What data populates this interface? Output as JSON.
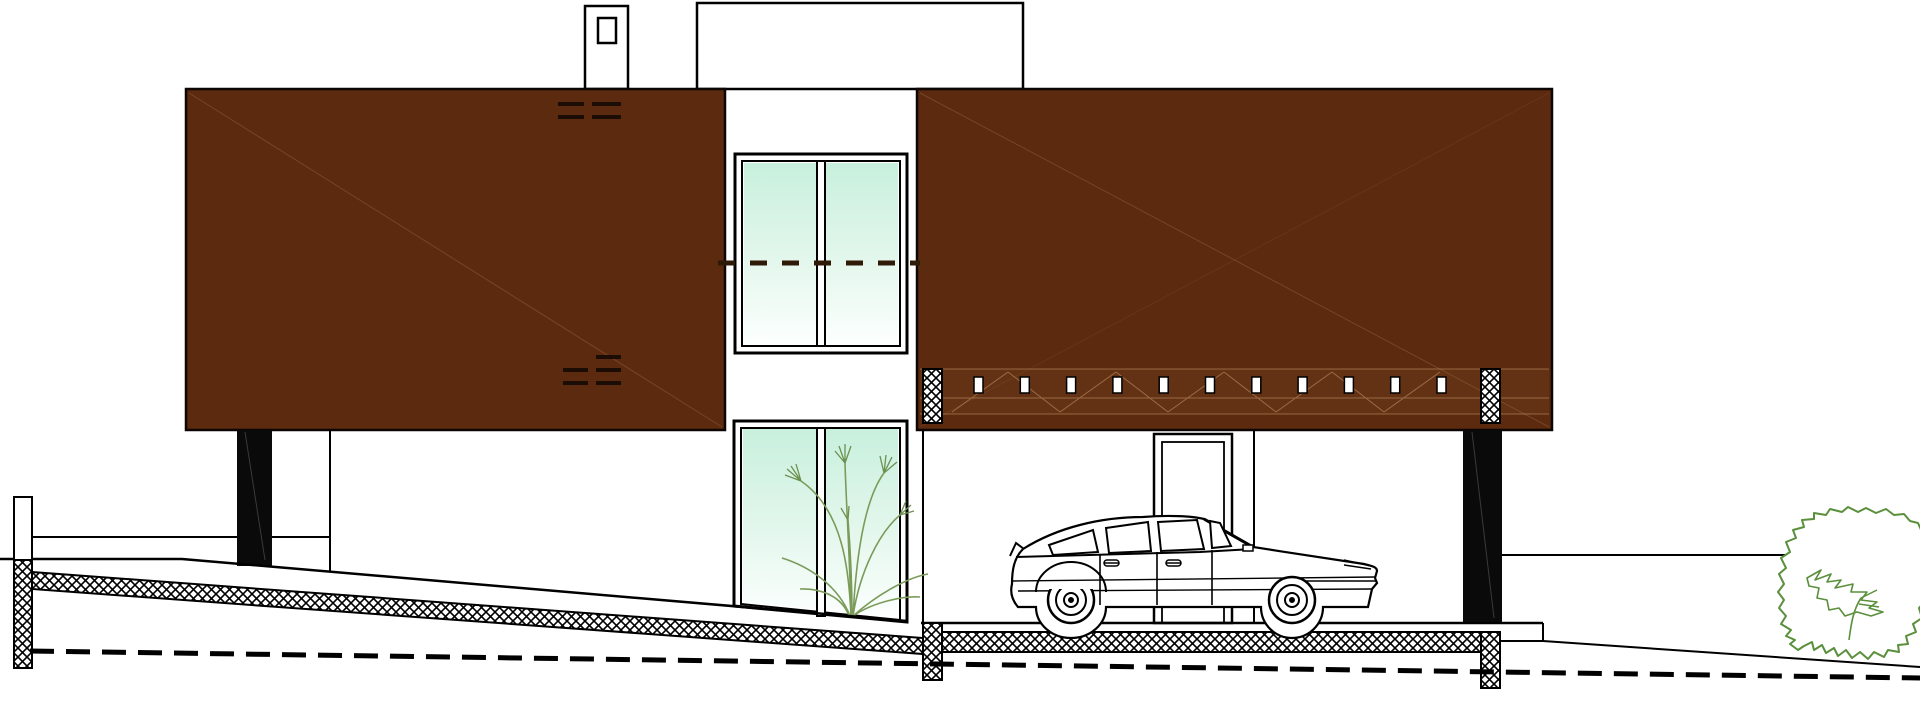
{
  "scene": {
    "kind": "architectural side elevation drawing",
    "elements": [
      "house",
      "car",
      "ramp",
      "tree",
      "chimney",
      "plant"
    ]
  },
  "colors": {
    "background": "#ffffff",
    "outline": "#000000",
    "facade": "#5b2a0f",
    "facade_mark": "#1c0d04",
    "panel_line": "#7b4b28",
    "band_line": "#c89a6a",
    "band_tint": "#8a5a33",
    "pillar": "#0a0a0a",
    "pillar_sheen": "#3a3a3a",
    "glass_top": "#c8f0dd",
    "glass_mid": "#e4f7ed",
    "glass_bottom": "#fcfffe",
    "window_dash": "#2f1a08",
    "plant": "#7b9b59",
    "plant_head": "#6d9150",
    "tree": "#5a8f3c"
  },
  "facade": {
    "slot_count": 11,
    "slot_start_x": 974,
    "slot_step": 46.3,
    "slot_y": 377,
    "slot_w": 9,
    "slot_h": 16
  },
  "windows": {
    "upper_pane_count": 2,
    "lower_pane_count": 2
  }
}
